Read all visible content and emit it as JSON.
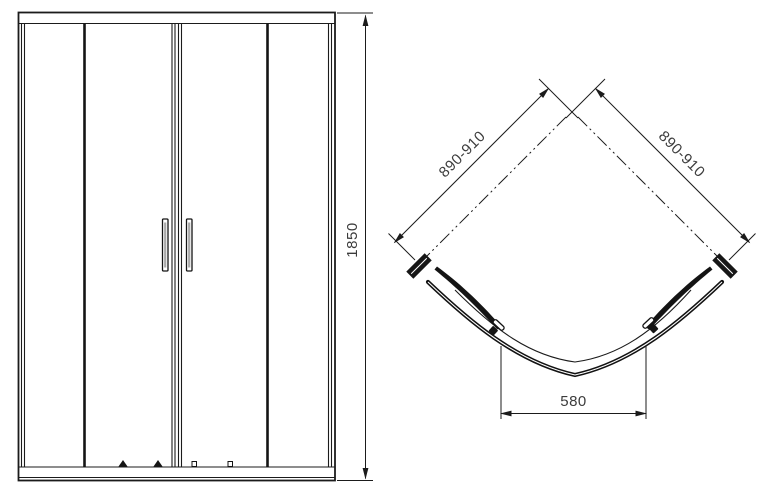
{
  "dims": {
    "height": "1850",
    "wall_left": "890-910",
    "wall_right": "890-910",
    "door_opening": "580"
  },
  "colors": {
    "line": "#1b1b1b",
    "dimension_text": "#3c3c3c",
    "handle_shade": "#a8a8a8",
    "background": "#ffffff"
  }
}
